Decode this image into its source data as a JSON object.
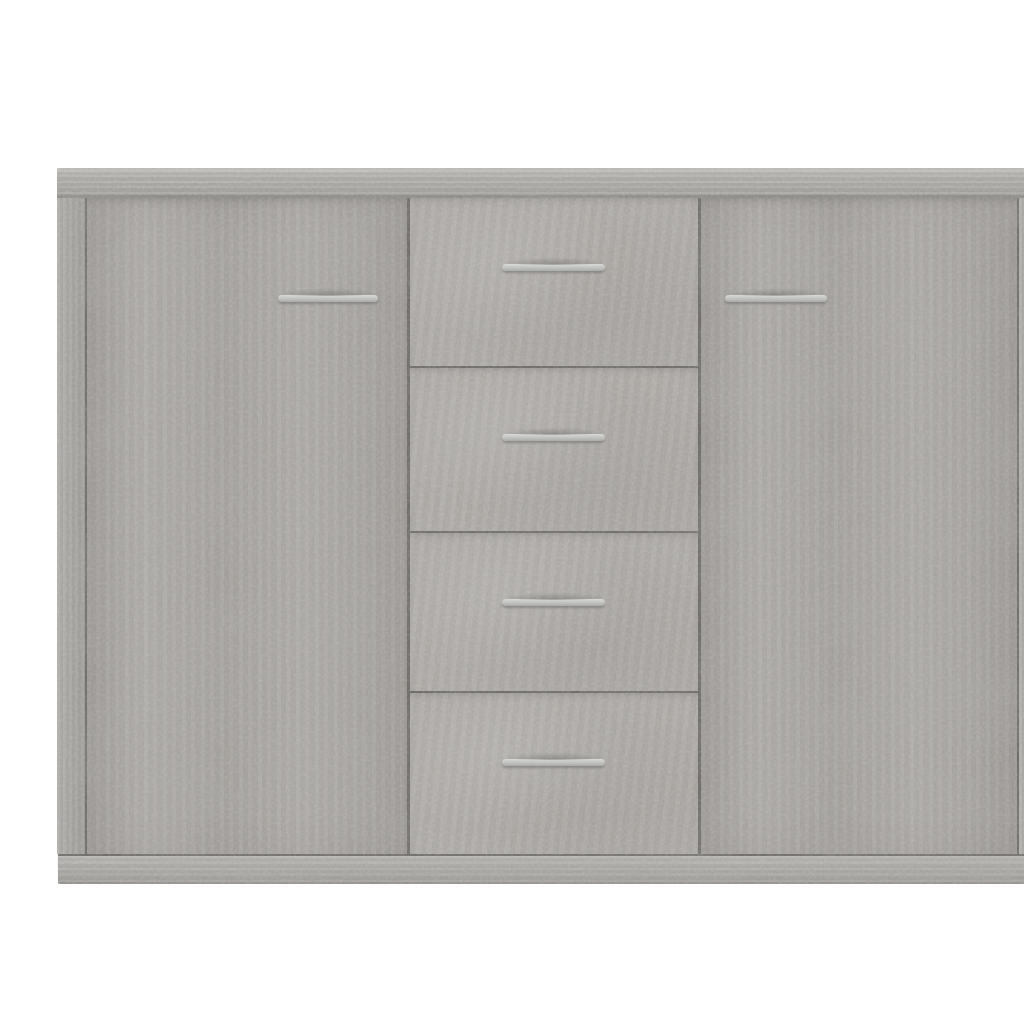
{
  "scene": {
    "description": "Product photo of a concrete-grey sideboard with two cabinet doors and four centre drawers, shown front-on against a plain white background",
    "product": "Sideboard",
    "finish": "Concrete grey",
    "background_style": "plain white studio background",
    "text_visible": "none"
  },
  "structure": {
    "doors": 2,
    "drawers": 4,
    "door_handles": 2,
    "drawer_handles": 4,
    "handle_style": "slim horizontal metal bar",
    "parts": [
      "top panel",
      "left side panel",
      "left door",
      "drawer stack",
      "right door",
      "right side panel",
      "plinth base"
    ]
  },
  "colors": {
    "background": "#ffffff",
    "top-panel": "#b2b0ac",
    "door": "#a9a6a2",
    "drawer": "#aeaba7",
    "side-panel": "#a6a4a0",
    "plinth": "#b1afab",
    "seam": "#6b6965",
    "edge-shadow": "#8b8985",
    "handle-light": "#d8dad8",
    "handle-dark": "#a9aba9"
  }
}
